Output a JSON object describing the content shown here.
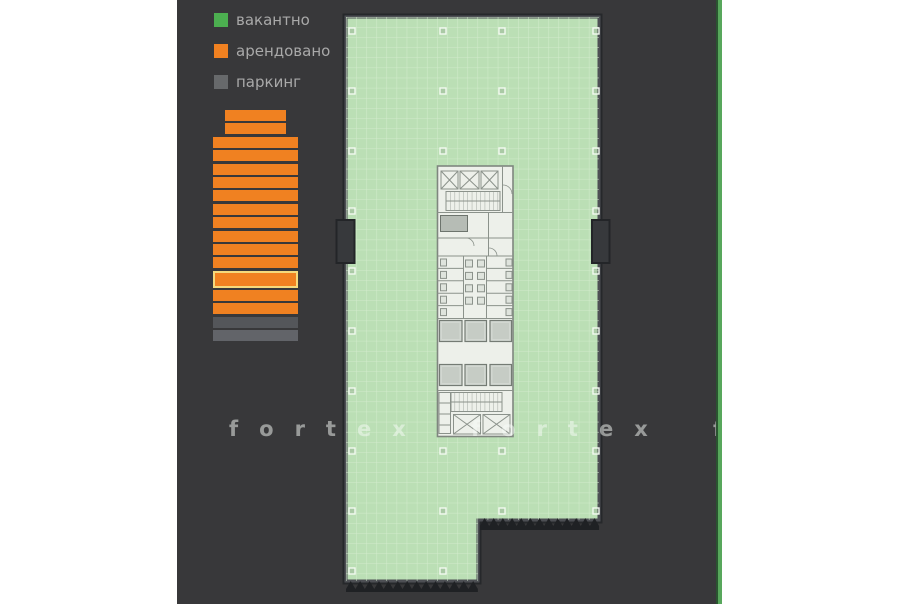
{
  "legend": {
    "items": [
      {
        "key": "vacant",
        "label": "вакантно",
        "color": "#4caf50"
      },
      {
        "key": "rented",
        "label": "арендовано",
        "color": "#f08121"
      },
      {
        "key": "parking",
        "label": "паркинг",
        "color": "#67696b"
      }
    ]
  },
  "building": {
    "selected_floor_index": 12,
    "floors": [
      {
        "status": "rented",
        "size": "narrow"
      },
      {
        "status": "rented",
        "size": "narrow"
      },
      {
        "status": "rented",
        "size": "wide"
      },
      {
        "status": "rented",
        "size": "wide"
      },
      {
        "status": "rented",
        "size": "wide"
      },
      {
        "status": "rented",
        "size": "wide"
      },
      {
        "status": "rented",
        "size": "wide"
      },
      {
        "status": "rented",
        "size": "wide"
      },
      {
        "status": "rented",
        "size": "wide"
      },
      {
        "status": "rented",
        "size": "wide"
      },
      {
        "status": "rented",
        "size": "wide"
      },
      {
        "status": "rented",
        "size": "wide"
      },
      {
        "status": "rented",
        "size": "wide",
        "selected": true
      },
      {
        "status": "rented",
        "size": "wide"
      },
      {
        "status": "rented",
        "size": "wide"
      },
      {
        "status": "parking",
        "size": "wide",
        "tone": "dark"
      },
      {
        "status": "parking",
        "size": "wide",
        "tone": "light"
      }
    ]
  },
  "floorplan": {
    "status": "vacant",
    "fill_color": "#bbdfb5",
    "column_markers": [
      [
        352,
        31
      ],
      [
        352,
        91
      ],
      [
        352,
        151
      ],
      [
        352,
        211
      ],
      [
        352,
        271
      ],
      [
        352,
        331
      ],
      [
        352,
        391
      ],
      [
        352,
        451
      ],
      [
        352,
        511
      ],
      [
        352,
        571
      ],
      [
        443,
        31
      ],
      [
        443,
        91
      ],
      [
        443,
        151
      ],
      [
        443,
        451
      ],
      [
        443,
        511
      ],
      [
        443,
        571
      ],
      [
        502,
        31
      ],
      [
        502,
        91
      ],
      [
        502,
        151
      ],
      [
        502,
        451
      ],
      [
        502,
        511
      ],
      [
        596,
        31
      ],
      [
        596,
        91
      ],
      [
        596,
        151
      ],
      [
        596,
        211
      ],
      [
        596,
        271
      ],
      [
        596,
        331
      ],
      [
        596,
        391
      ],
      [
        596,
        451
      ],
      [
        596,
        511
      ]
    ]
  },
  "watermark": {
    "text": "fortex",
    "repeats": 3
  },
  "colors": {
    "panel_bg": "#38383a",
    "rented_orange": "#f08121",
    "selected_border": "#f4d97c",
    "parking_gray_dark": "#54565a",
    "parking_gray_light": "#626469",
    "plan_green": "#bbdfb5",
    "plan_grid": "#d2ebcc",
    "stripe_green": "#58a75c"
  }
}
